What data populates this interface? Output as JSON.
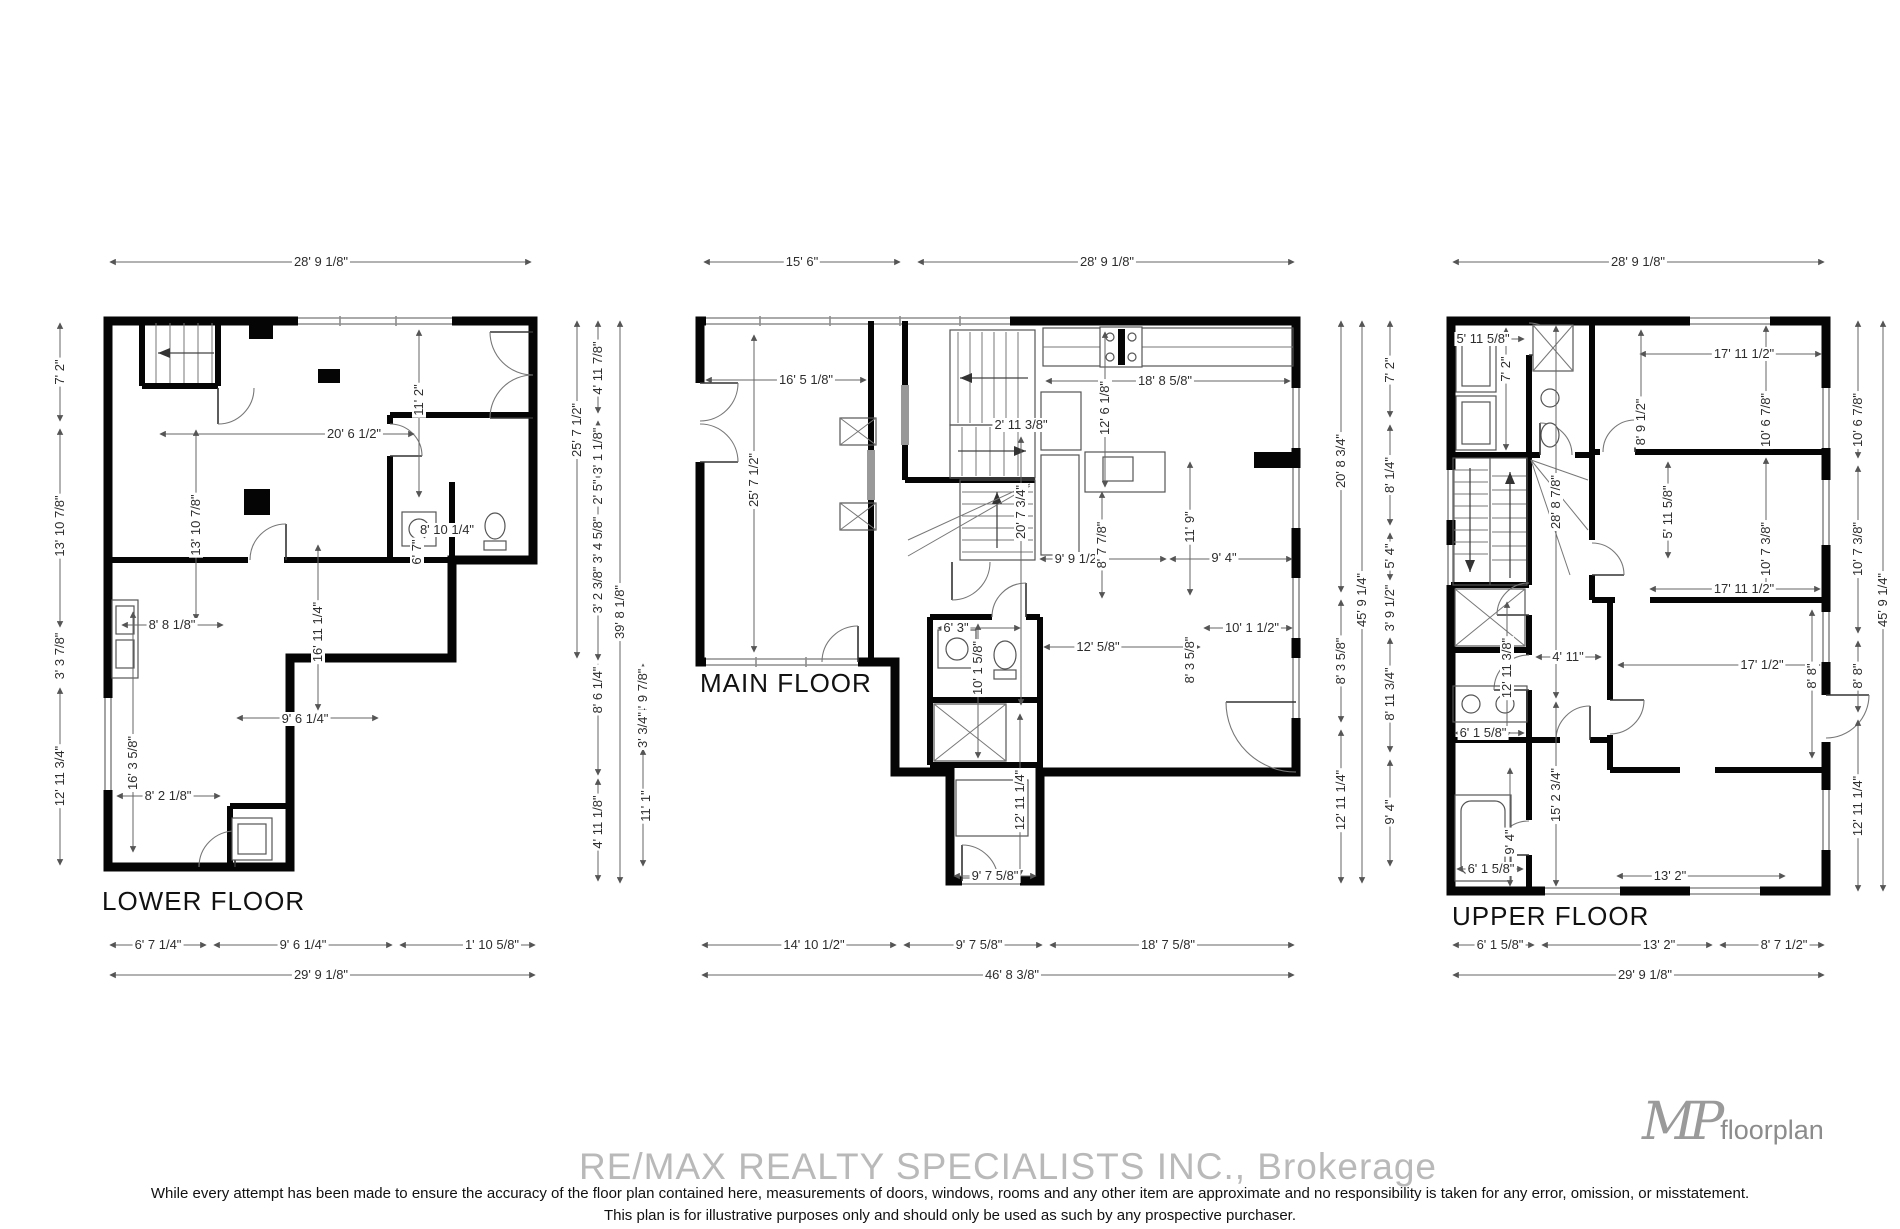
{
  "meta": {
    "watermark": "RE/MAX REALTY SPECIALISTS INC.,  Brokerage",
    "disclaimer_line1": "While every attempt has been made to ensure the accuracy of the floor plan contained here, measurements of doors, windows, rooms and any other item are approximate and no responsibility is taken for any error, omission, or misstatement.",
    "disclaim_line2_note": "second disclaimer line",
    "disclaimer_line2": "This plan is for illustrative purposes only and should only be used as such by any prospective purchaser.",
    "logo_monogram": "MP",
    "logo_text": "floorplan",
    "colors": {
      "wall": "#050505",
      "dimension_text": "#2d2d2d",
      "watermark": "#b9b9b9"
    }
  },
  "floors": [
    {
      "id": "lower",
      "label": "LOWER FLOOR",
      "label_x": 102,
      "label_y": 886,
      "dims": [
        {
          "t": "28' 9 1/8\"",
          "x": 321,
          "y": 262,
          "r": 0
        },
        {
          "t": "7' 2\"",
          "x": 60,
          "y": 372,
          "r": 1
        },
        {
          "t": "13' 10 7/8\"",
          "x": 60,
          "y": 526,
          "r": 1
        },
        {
          "t": "3' 3 7/8\"",
          "x": 60,
          "y": 656,
          "r": 1
        },
        {
          "t": "12' 11 3/4\"",
          "x": 60,
          "y": 776,
          "r": 1
        },
        {
          "t": "20' 6 1/2\"",
          "x": 354,
          "y": 434,
          "r": 0
        },
        {
          "t": "11' 2\"",
          "x": 419,
          "y": 400,
          "r": 1
        },
        {
          "t": "13' 10 7/8\"",
          "x": 196,
          "y": 525,
          "r": 1
        },
        {
          "t": "16' 11 1/4\"",
          "x": 318,
          "y": 632,
          "r": 1
        },
        {
          "t": "8' 8 1/8\"",
          "x": 172,
          "y": 625,
          "r": 0
        },
        {
          "t": "8' 10 1/4\"",
          "x": 447,
          "y": 530,
          "r": 0
        },
        {
          "t": "6' 7\"",
          "x": 417,
          "y": 552,
          "r": 1
        },
        {
          "t": "9' 6 1/4\"",
          "x": 305,
          "y": 719,
          "r": 0
        },
        {
          "t": "16' 3 5/8\"",
          "x": 133,
          "y": 763,
          "r": 1
        },
        {
          "t": "8' 2 1/8\"",
          "x": 168,
          "y": 796,
          "r": 0
        },
        {
          "t": "6' 7 1/4\"",
          "x": 158,
          "y": 945,
          "r": 0
        },
        {
          "t": "9' 6 1/4\"",
          "x": 303,
          "y": 945,
          "r": 0
        },
        {
          "t": "1' 10 5/8\"",
          "x": 492,
          "y": 945,
          "r": 0
        },
        {
          "t": "29' 9 1/8\"",
          "x": 321,
          "y": 975,
          "r": 0
        }
      ]
    },
    {
      "id": "main",
      "label": "MAIN FLOOR",
      "label_x": 700,
      "label_y": 668,
      "dims": [
        {
          "t": "15' 6\"",
          "x": 802,
          "y": 262,
          "r": 0
        },
        {
          "t": "28' 9 1/8\"",
          "x": 1107,
          "y": 262,
          "r": 0
        },
        {
          "t": "25' 7 1/2\"",
          "x": 577,
          "y": 430,
          "r": 1
        },
        {
          "t": "4' 11 7/8\"",
          "x": 598,
          "y": 368,
          "r": 1
        },
        {
          "t": "3' 1 1/8\"",
          "x": 598,
          "y": 451,
          "r": 1
        },
        {
          "t": "2' 5\"",
          "x": 598,
          "y": 492,
          "r": 1
        },
        {
          "t": "3' 4 5/8\"",
          "x": 598,
          "y": 540,
          "r": 1
        },
        {
          "t": "3' 2 3/8\"",
          "x": 598,
          "y": 590,
          "r": 1
        },
        {
          "t": "8' 6 1/4\"",
          "x": 598,
          "y": 690,
          "r": 1
        },
        {
          "t": "4' 11 1/8\"",
          "x": 598,
          "y": 822,
          "r": 1
        },
        {
          "t": "39' 8 1/8\"",
          "x": 620,
          "y": 612,
          "r": 1
        },
        {
          "t": "4' 9 7/8\"",
          "x": 643,
          "y": 692,
          "r": 1
        },
        {
          "t": "3' 3/4\"",
          "x": 643,
          "y": 730,
          "r": 1
        },
        {
          "t": "11' 1\"",
          "x": 646,
          "y": 806,
          "r": 1
        },
        {
          "t": "16' 5 1/8\"",
          "x": 806,
          "y": 380,
          "r": 0
        },
        {
          "t": "25' 7 1/2\"",
          "x": 754,
          "y": 480,
          "r": 1
        },
        {
          "t": "2' 11 3/8\"",
          "x": 1021,
          "y": 425,
          "r": 0
        },
        {
          "t": "20' 7 3/4\"",
          "x": 1021,
          "y": 512,
          "r": 1
        },
        {
          "t": "18' 8 5/8\"",
          "x": 1165,
          "y": 381,
          "r": 0
        },
        {
          "t": "12' 6 1/8\"",
          "x": 1105,
          "y": 408,
          "r": 1
        },
        {
          "t": "11' 9\"",
          "x": 1190,
          "y": 527,
          "r": 1
        },
        {
          "t": "9' 9 1/2\"",
          "x": 1078,
          "y": 559,
          "r": 0
        },
        {
          "t": "8' 7 7/8\"",
          "x": 1102,
          "y": 545,
          "r": 1
        },
        {
          "t": "9' 4\"",
          "x": 1224,
          "y": 558,
          "r": 0
        },
        {
          "t": "6' 3\"",
          "x": 956,
          "y": 628,
          "r": 0
        },
        {
          "t": "10' 1 5/8\"",
          "x": 978,
          "y": 668,
          "r": 1
        },
        {
          "t": "12' 5/8\"",
          "x": 1098,
          "y": 647,
          "r": 0
        },
        {
          "t": "10' 1 1/2\"",
          "x": 1252,
          "y": 628,
          "r": 0
        },
        {
          "t": "8' 3 5/8\"",
          "x": 1190,
          "y": 660,
          "r": 1
        },
        {
          "t": "12' 11 1/4\"",
          "x": 1020,
          "y": 800,
          "r": 1
        },
        {
          "t": "9' 7 5/8\"",
          "x": 995,
          "y": 876,
          "r": 0
        },
        {
          "t": "14' 10 1/2\"",
          "x": 814,
          "y": 945,
          "r": 0
        },
        {
          "t": "9' 7 5/8\"",
          "x": 979,
          "y": 945,
          "r": 0
        },
        {
          "t": "18' 7 5/8\"",
          "x": 1168,
          "y": 945,
          "r": 0
        },
        {
          "t": "46' 8 3/8\"",
          "x": 1012,
          "y": 975,
          "r": 0
        },
        {
          "t": "20' 8 3/4\"",
          "x": 1341,
          "y": 461,
          "r": 1
        },
        {
          "t": "8' 3 5/8\"",
          "x": 1341,
          "y": 661,
          "r": 1
        },
        {
          "t": "12' 11 1/4\"",
          "x": 1341,
          "y": 800,
          "r": 1
        },
        {
          "t": "45' 9 1/4\"",
          "x": 1362,
          "y": 600,
          "r": 1
        },
        {
          "t": "7' 2\"",
          "x": 1390,
          "y": 370,
          "r": 1
        },
        {
          "t": "8' 1/4\"",
          "x": 1390,
          "y": 475,
          "r": 1
        },
        {
          "t": "5' 4\"",
          "x": 1390,
          "y": 556,
          "r": 1
        },
        {
          "t": "3' 9 1/2\"",
          "x": 1390,
          "y": 608,
          "r": 1
        },
        {
          "t": "8' 11 3/4\"",
          "x": 1390,
          "y": 694,
          "r": 1
        },
        {
          "t": "9' 4\"",
          "x": 1390,
          "y": 812,
          "r": 1
        }
      ]
    },
    {
      "id": "upper",
      "label": "UPPER FLOOR",
      "label_x": 1452,
      "label_y": 901,
      "dims": [
        {
          "t": "28' 9 1/8\"",
          "x": 1638,
          "y": 262,
          "r": 0
        },
        {
          "t": "5' 11 5/8\"",
          "x": 1483,
          "y": 339,
          "r": 0
        },
        {
          "t": "7' 2\"",
          "x": 1506,
          "y": 369,
          "r": 1
        },
        {
          "t": "17' 11 1/2\"",
          "x": 1744,
          "y": 354,
          "r": 0
        },
        {
          "t": "10' 6 7/8\"",
          "x": 1766,
          "y": 420,
          "r": 1
        },
        {
          "t": "8' 9 1/2\"",
          "x": 1641,
          "y": 422,
          "r": 1
        },
        {
          "t": "5' 11 5/8\"",
          "x": 1668,
          "y": 512,
          "r": 1
        },
        {
          "t": "10' 7 3/8\"",
          "x": 1766,
          "y": 549,
          "r": 1
        },
        {
          "t": "17' 11 1/2\"",
          "x": 1744,
          "y": 589,
          "r": 0
        },
        {
          "t": "28' 8 7/8\"",
          "x": 1556,
          "y": 502,
          "r": 1
        },
        {
          "t": "12' 11 3/8\"",
          "x": 1507,
          "y": 668,
          "r": 1
        },
        {
          "t": "4' 11\"",
          "x": 1568,
          "y": 657,
          "r": 0
        },
        {
          "t": "17' 1/2\"",
          "x": 1762,
          "y": 665,
          "r": 0
        },
        {
          "t": "8' 8\"",
          "x": 1812,
          "y": 676,
          "r": 1
        },
        {
          "t": "6' 1 5/8\"",
          "x": 1483,
          "y": 733,
          "r": 0
        },
        {
          "t": "15' 2 3/4\"",
          "x": 1556,
          "y": 795,
          "r": 1
        },
        {
          "t": "9' 4\"",
          "x": 1510,
          "y": 842,
          "r": 1
        },
        {
          "t": "6' 1 5/8\"",
          "x": 1491,
          "y": 869,
          "r": 0
        },
        {
          "t": "13' 2\"",
          "x": 1670,
          "y": 876,
          "r": 0
        },
        {
          "t": "6' 1 5/8\"",
          "x": 1500,
          "y": 945,
          "r": 0
        },
        {
          "t": "13' 2\"",
          "x": 1659,
          "y": 945,
          "r": 0
        },
        {
          "t": "8' 7 1/2\"",
          "x": 1784,
          "y": 945,
          "r": 0
        },
        {
          "t": "29' 9 1/8\"",
          "x": 1645,
          "y": 975,
          "r": 0
        },
        {
          "t": "10' 6 7/8\"",
          "x": 1858,
          "y": 420,
          "r": 1
        },
        {
          "t": "10' 7 3/8\"",
          "x": 1858,
          "y": 549,
          "r": 1
        },
        {
          "t": "8' 8\"",
          "x": 1858,
          "y": 676,
          "r": 1
        },
        {
          "t": "12' 11 1/4\"",
          "x": 1858,
          "y": 806,
          "r": 1
        },
        {
          "t": "45' 9 1/4\"",
          "x": 1883,
          "y": 600,
          "r": 1
        }
      ]
    }
  ]
}
